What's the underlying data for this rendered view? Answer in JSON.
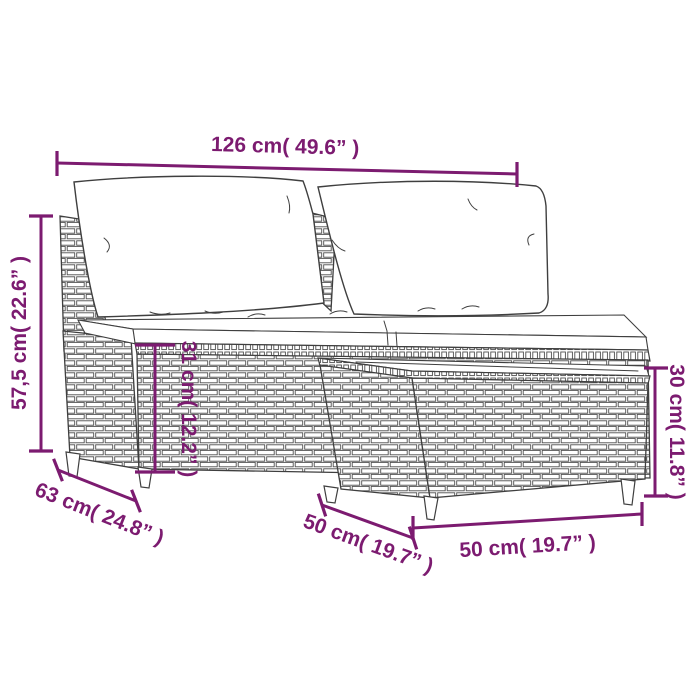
{
  "meta": {
    "description": "Dimension diagram of a grey poly-rattan garden lounge set: two armless sofa sections with back and seat cushions plus a square ottoman footstool, drawn as black line art on white with magenta measurement annotations.",
    "background": "#ffffff"
  },
  "style": {
    "dimension_color": "#7c1b70",
    "outline_color": "#3f3f3f"
  },
  "dims": {
    "total_width": "126 cm( 49.6” )",
    "total_height": "57,5 cm( 22.6” )",
    "seat_height": "31 cm( 12.2” )",
    "sofa_depth": "63 cm( 24.8” )",
    "ottoman_depth": "50 cm( 19.7” )",
    "ottoman_width": "50 cm( 19.7” )",
    "ottoman_height": "30 cm( 11.8” )"
  }
}
